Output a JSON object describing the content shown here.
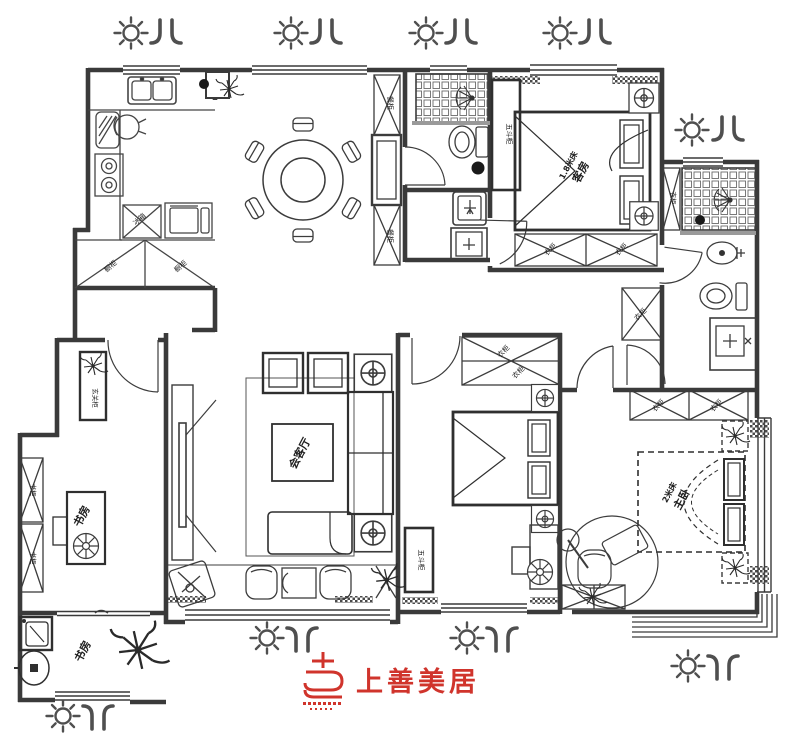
{
  "colors": {
    "wall": "#3a3a3a",
    "furniture_line": "#474747",
    "accent_red": "#d0342c",
    "icon_gray": "#4f4f4f",
    "background": "#ffffff"
  },
  "rooms": {
    "guest_room": {
      "name": "客房",
      "bed": "1.8米床"
    },
    "living_room": {
      "name": "会客厅"
    },
    "master_bedroom": {
      "name": "主卧",
      "bed": "2米床"
    },
    "study": {
      "name": "书房"
    },
    "utility_study": {
      "name": "书房"
    }
  },
  "cabinet_labels": {
    "wardrobe": "衣柜",
    "five_drawer_chest": "五斗柜",
    "bookcase": "书柜",
    "entry_cabinet": "玄关柜",
    "dining_cabinet": "餐柜",
    "kitchen_base_cabinet": "橱柜",
    "fridge": "冰箱"
  },
  "icons": {
    "sun": "sun-icon",
    "airflow": "airflow-icon"
  },
  "logo": {
    "brand": "上善美居"
  }
}
